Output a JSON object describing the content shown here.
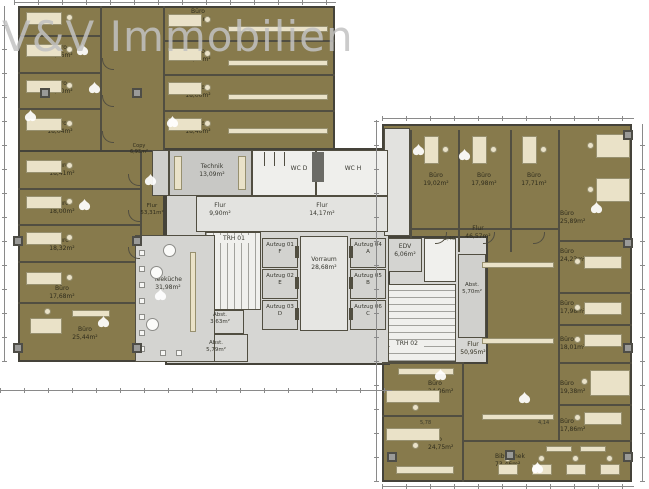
{
  "watermark": {
    "brand": "V&V Immobilien"
  },
  "plan": {
    "offices_left_outer": [
      {
        "name": "Büro",
        "area": "16,46m²"
      },
      {
        "name": "Büro",
        "area": "18,90m²"
      },
      {
        "name": "Büro",
        "area": "18,04m²"
      },
      {
        "name": "Büro",
        "area": "18,41m²"
      },
      {
        "name": "Büro",
        "area": "18,00m²"
      },
      {
        "name": "Büro",
        "area": "18,32m²"
      },
      {
        "name": "Büro",
        "area": "17,68m²"
      },
      {
        "name": "Büro",
        "area": "25,44m²"
      }
    ],
    "offices_left_inner": [
      {
        "name": "Büro",
        "area": "19,84m²"
      },
      {
        "name": "Büro",
        "area": "16,45m²"
      },
      {
        "name": "Büro",
        "area": "18,00m²"
      },
      {
        "name": "Büro",
        "area": "18,40m²"
      }
    ],
    "offices_right_top": [
      {
        "name": "Büro",
        "area": "19,02m²"
      },
      {
        "name": "Büro",
        "area": "17,98m²"
      },
      {
        "name": "Büro",
        "area": "17,71m²"
      }
    ],
    "offices_right_east": [
      {
        "name": "Büro",
        "area": "25,89m²"
      },
      {
        "name": "Büro",
        "area": "24,23m²"
      },
      {
        "name": "Büro",
        "area": "17,98m²"
      },
      {
        "name": "Büro",
        "area": "18,01m²"
      },
      {
        "name": "Büro",
        "area": "19,38m²"
      },
      {
        "name": "Büro",
        "area": "17,86m²"
      }
    ],
    "offices_right_west": [
      {
        "name": "Büro",
        "area": "24,86m²"
      },
      {
        "name": "Büro",
        "area": "24,75m²"
      }
    ],
    "library": {
      "name": "Bibliothek",
      "area": "73,46m²"
    },
    "core": {
      "copy": {
        "name": "Copy",
        "area": "6,93m²"
      },
      "technik": {
        "name": "Technik",
        "area": "13,09m²"
      },
      "wc_d": {
        "name": "WC D"
      },
      "wc_h": {
        "name": "WC H"
      },
      "flur_center": {
        "name": "Flur",
        "area": "14,17m²"
      },
      "flur_small": {
        "name": "Flur",
        "area": "9,90m²"
      },
      "flur_west": {
        "name": "Flur",
        "area": "53,31m²"
      },
      "flur_east_top": {
        "name": "Flur",
        "area": "46,57m²"
      },
      "flur_east_bottom": {
        "name": "Flur",
        "area": "50,95m²"
      },
      "stair1": {
        "name": "TRH 01"
      },
      "stair2": {
        "name": "TRH 02"
      },
      "vorraum": {
        "name": "Vorraum",
        "area": "28,68m²"
      },
      "edv": {
        "name": "EDV",
        "area": "6,06m²"
      },
      "abst_a": {
        "name": "Abst.",
        "area": "3,63m²"
      },
      "abst_b": {
        "name": "Abst.",
        "area": "5,79m²"
      },
      "abst_c": {
        "name": "Abst.",
        "area": "5,70m²"
      },
      "teekueche": {
        "name": "Teeküche",
        "area": "31,98m²"
      },
      "elevators": [
        {
          "name": "Aufzug 01",
          "letter": "F"
        },
        {
          "name": "Aufzug 02",
          "letter": "E"
        },
        {
          "name": "Aufzug 03",
          "letter": "D"
        },
        {
          "name": "Aufzug 04",
          "letter": "A"
        },
        {
          "name": "Aufzug 05",
          "letter": "B"
        },
        {
          "name": "Aufzug 06",
          "letter": "C"
        }
      ]
    },
    "dimensions": [
      "5,78",
      "4,14",
      "1,40"
    ]
  },
  "colors": {
    "office_fill": "#877a4c",
    "core_fill": "#d6d6d3",
    "wall": "#514e41",
    "furniture": "#eae2c8",
    "watermark": "#c2c2c2"
  }
}
